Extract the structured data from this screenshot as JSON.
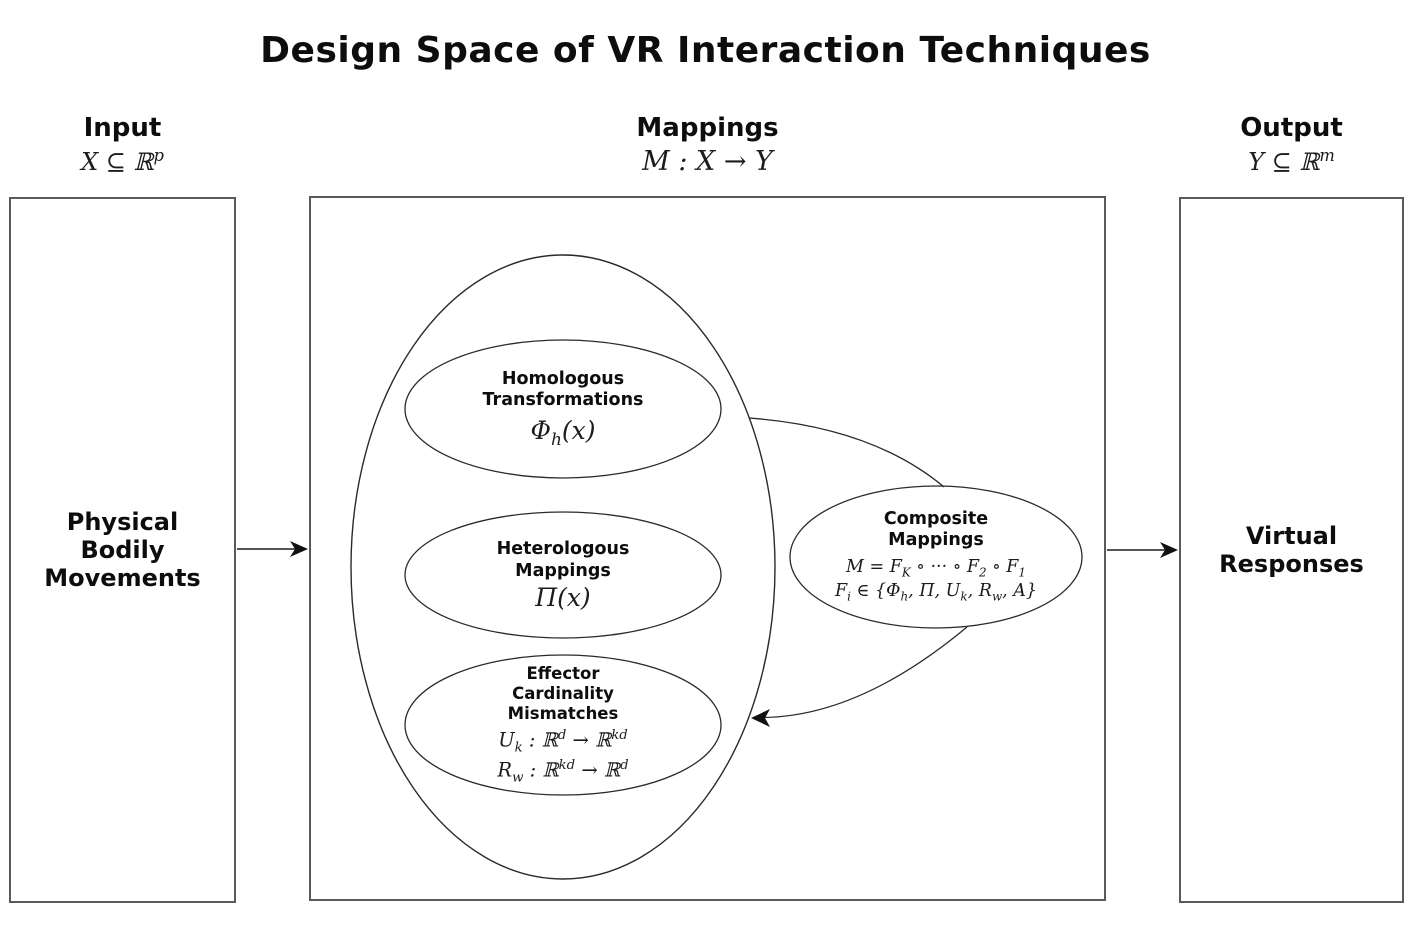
{
  "title": "Design Space of VR Interaction Techniques",
  "columns": {
    "input": {
      "label": "Input",
      "formula": "X ⊆ ℝ^{p}"
    },
    "mappings": {
      "label": "Mappings",
      "formula": "M : X → Y"
    },
    "output": {
      "label": "Output",
      "formula": "Y ⊆ ℝ^{m}"
    }
  },
  "input_box": {
    "lines": [
      "Physical",
      "Bodily",
      "Movements"
    ]
  },
  "output_box": {
    "lines": [
      "Virtual",
      "Responses"
    ]
  },
  "ellipses": {
    "homologous": {
      "title_lines": [
        "Homologous",
        "Transformations"
      ],
      "formula": "Φ_{h}(x)"
    },
    "heterologous": {
      "title_lines": [
        "Heterologous",
        "Mappings"
      ],
      "formula": "Π(x)"
    },
    "effector": {
      "title_lines": [
        "Effector",
        "Cardinality",
        "Mismatches"
      ],
      "formula_1": "U_{k} : ℝ^{d} → ℝ^{kd}",
      "formula_2": "R_{w} : ℝ^{kd} → ℝ^{d}"
    },
    "composite": {
      "title_lines": [
        "Composite",
        "Mappings"
      ],
      "formula_1": "M  =  F_{K} ∘ ··· ∘ F_{2} ∘ F_{1}",
      "formula_2": "F_{i} ∈ {Φ_{h},  Π,  U_{k},  R_{w},  A}"
    }
  },
  "colors": {
    "box_stroke": "#5a5a5a",
    "ellipse_stroke": "#2a2a2a",
    "arrow_line": "#555555",
    "arrow_head": "#111111"
  }
}
